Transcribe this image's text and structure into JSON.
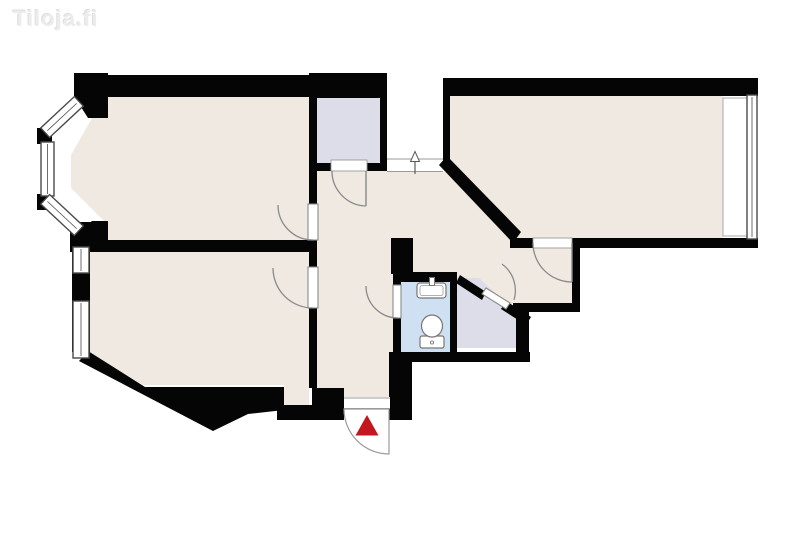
{
  "watermark": {
    "text": "Tiloja.fi"
  },
  "canvas": {
    "width": 800,
    "height": 533
  },
  "colors": {
    "background": "#ffffff",
    "floor_cream": "#f0e9e1",
    "closet_lavender": "#dcdde8",
    "bathroom_blue": "#cfe0f2",
    "wall_black": "#050505",
    "door_gray": "#8a8a8a",
    "thin_line_gray": "#9a9a9a",
    "window_frame": "#4a4a4a",
    "entrance_red": "#c4161f"
  },
  "floorplan": {
    "shapes": [
      {
        "n": "room-topleft-floor",
        "t": "polygon",
        "pts": "104,97 309,97 309,240 104,240 104,221 71,188 71,155",
        "f": "#f0e9e1"
      },
      {
        "n": "room-bottomleft-floor",
        "t": "polygon",
        "pts": "90,252 309,252 309,406 284,406 284,385 143,385 90,354",
        "f": "#f0e9e1"
      },
      {
        "n": "room-topright-floor",
        "t": "rect",
        "x": 450,
        "y": 96,
        "w": 273,
        "h": 142,
        "f": "#f0e9e1"
      },
      {
        "n": "hallway-floor-corridor",
        "t": "rect",
        "x": 317,
        "y": 168,
        "w": 77,
        "h": 241,
        "f": "#f0e9e1"
      },
      {
        "n": "hallway-floor-upper",
        "t": "rect",
        "x": 387,
        "y": 172,
        "w": 56,
        "h": 68,
        "f": "#f0e9e1"
      },
      {
        "n": "hallway-floor-nook",
        "t": "rect",
        "x": 394,
        "y": 172,
        "w": 178,
        "h": 134,
        "f": "#f0e9e1"
      },
      {
        "n": "closet-top-floor",
        "t": "rect",
        "x": 316,
        "y": 98,
        "w": 64,
        "h": 65,
        "f": "#dcdde8"
      },
      {
        "n": "closet-side-floor",
        "t": "polygon",
        "pts": "457,278 479,278 516,313 516,348 457,348",
        "f": "#dcdde8"
      },
      {
        "n": "bathroom-floor",
        "t": "rect",
        "x": 401,
        "y": 282,
        "w": 49,
        "h": 70,
        "f": "#cfe0f2"
      },
      {
        "n": "stair-landing",
        "t": "rect",
        "x": 387,
        "y": 96,
        "w": 56,
        "h": 76,
        "f": "#ffffff"
      },
      {
        "n": "landing-threshold-line-upper",
        "t": "line",
        "x1": 387,
        "y1": 159,
        "x2": 443,
        "y2": 159,
        "s": "#9a9a9a",
        "sw": 1
      },
      {
        "n": "landing-threshold-line-lower",
        "t": "line",
        "x1": 387,
        "y1": 171.5,
        "x2": 443,
        "y2": 171.5,
        "s": "#9a9a9a",
        "sw": 1
      },
      {
        "n": "direction-arrow-icon-stem",
        "t": "line",
        "x1": 415,
        "y1": 174,
        "x2": 415,
        "y2": 161,
        "s": "#5a5a5a",
        "sw": 1.2
      },
      {
        "n": "direction-arrow-icon-head",
        "t": "polygon",
        "pts": "410.5,161.5 419.5,161.5 415,151.5",
        "f": "#ffffff",
        "s": "#5a5a5a",
        "sw": 1
      },
      {
        "n": "wall-room-topleft-top",
        "t": "rect",
        "x": 77,
        "y": 75,
        "w": 241,
        "h": 22,
        "f": "#050505"
      },
      {
        "n": "wall-closet-top-top",
        "t": "rect",
        "x": 309,
        "y": 73,
        "w": 78,
        "h": 25,
        "f": "#050505"
      },
      {
        "n": "wall-closet-top-left",
        "t": "rect",
        "x": 309,
        "y": 97,
        "w": 8,
        "h": 74,
        "f": "#050505"
      },
      {
        "n": "wall-closet-top-right",
        "t": "rect",
        "x": 380,
        "y": 97,
        "w": 7,
        "h": 74,
        "f": "#050505"
      },
      {
        "n": "wall-closet-top-bottom-left",
        "t": "rect",
        "x": 309,
        "y": 163,
        "w": 23,
        "h": 8,
        "f": "#050505"
      },
      {
        "n": "wall-closet-top-bottom-right",
        "t": "rect",
        "x": 366,
        "y": 163,
        "w": 21,
        "h": 8,
        "f": "#050505"
      },
      {
        "n": "wall-hall-left-seg1",
        "t": "rect",
        "x": 309,
        "y": 171,
        "w": 8,
        "h": 34,
        "f": "#050505"
      },
      {
        "n": "wall-hall-left-seg2",
        "t": "rect",
        "x": 309,
        "y": 239,
        "w": 8,
        "h": 29,
        "f": "#050505"
      },
      {
        "n": "wall-hall-left-seg3",
        "t": "rect",
        "x": 309,
        "y": 308,
        "w": 8,
        "h": 80,
        "f": "#050505"
      },
      {
        "n": "wall-between-left-rooms",
        "t": "rect",
        "x": 85,
        "y": 240,
        "w": 232,
        "h": 12,
        "f": "#050505"
      },
      {
        "n": "wall-room-topright-top",
        "t": "rect",
        "x": 443,
        "y": 78,
        "w": 315,
        "h": 18,
        "f": "#050505"
      },
      {
        "n": "wall-room-topright-left",
        "t": "rect",
        "x": 443,
        "y": 96,
        "w": 7,
        "h": 70,
        "f": "#050505"
      },
      {
        "n": "wall-diagonal-hall",
        "t": "polygon",
        "pts": "447,156 521,232 513,243 439,165",
        "f": "#050505"
      },
      {
        "n": "wall-room-topright-bottom-left",
        "t": "rect",
        "x": 510,
        "y": 238,
        "w": 23,
        "h": 10,
        "f": "#050505"
      },
      {
        "n": "wall-room-topright-bottom-right",
        "t": "rect",
        "x": 572,
        "y": 238,
        "w": 186,
        "h": 10,
        "f": "#050505"
      },
      {
        "n": "wall-nook-right",
        "t": "rect",
        "x": 572,
        "y": 238,
        "w": 8,
        "h": 74,
        "f": "#050505"
      },
      {
        "n": "wall-nook-bottom",
        "t": "rect",
        "x": 513,
        "y": 303,
        "w": 67,
        "h": 9,
        "f": "#050505"
      },
      {
        "n": "wall-closet-side-right",
        "t": "rect",
        "x": 516,
        "y": 311,
        "w": 13,
        "h": 41,
        "f": "#050505"
      },
      {
        "n": "wall-bottom-center",
        "t": "rect",
        "x": 393,
        "y": 352,
        "w": 137,
        "h": 10,
        "f": "#050505"
      },
      {
        "n": "wall-bathroom-right",
        "t": "rect",
        "x": 450,
        "y": 272,
        "w": 7,
        "h": 80,
        "f": "#050505"
      },
      {
        "n": "wall-bathroom-top",
        "t": "rect",
        "x": 393,
        "y": 272,
        "w": 64,
        "h": 10,
        "f": "#050505"
      },
      {
        "n": "wall-bathroom-left-upper",
        "t": "rect",
        "x": 393,
        "y": 274,
        "w": 8,
        "h": 11,
        "f": "#050505"
      },
      {
        "n": "wall-bathroom-left-lower",
        "t": "rect",
        "x": 393,
        "y": 318,
        "w": 8,
        "h": 34,
        "f": "#050505"
      },
      {
        "n": "wall-chunk-above-bathroom",
        "t": "rect",
        "x": 391,
        "y": 238,
        "w": 22,
        "h": 36,
        "f": "#050505"
      },
      {
        "n": "wall-closet-side-diag-upper",
        "t": "polygon",
        "pts": "460,275 486,292 482,300 456,283",
        "f": "#050505"
      },
      {
        "n": "wall-closet-side-diag-lower",
        "t": "polygon",
        "pts": "506,301 531,317 526,325 501,309",
        "f": "#050505"
      },
      {
        "n": "wall-entrance-left-jamb",
        "t": "rect",
        "x": 312,
        "y": 388,
        "w": 32,
        "h": 32,
        "f": "#050505"
      },
      {
        "n": "wall-entrance-right-jamb",
        "t": "rect",
        "x": 389,
        "y": 352,
        "w": 23,
        "h": 68,
        "f": "#050505"
      },
      {
        "n": "wall-room-bottomleft-bottom",
        "t": "polygon",
        "pts": "88,351 145,387 284,387 284,410 248,414 213,431 79,361",
        "f": "#050505"
      },
      {
        "n": "wall-notch-bottom",
        "t": "rect",
        "x": 277,
        "y": 405,
        "w": 36,
        "h": 15,
        "f": "#050505"
      },
      {
        "n": "wall-room-bottomleft-left",
        "t": "rect",
        "x": 72,
        "y": 244,
        "w": 18,
        "h": 108,
        "f": "#050505"
      },
      {
        "n": "wall-left-corner-piece",
        "t": "rect",
        "x": 70,
        "y": 222,
        "w": 36,
        "h": 30,
        "f": "#050505"
      },
      {
        "n": "wall-bay-top-corner",
        "t": "polygon",
        "pts": "74,73 108,73 108,118 88,118 74,96",
        "f": "#050505"
      },
      {
        "n": "wall-bay-bottom-corner",
        "t": "polygon",
        "pts": "92,221 108,221 108,252 70,252 70,241",
        "f": "#050505"
      },
      {
        "n": "wall-bay-wedge-upper",
        "t": "rect",
        "x": 37,
        "y": 128,
        "w": 15,
        "h": 16,
        "f": "#050505"
      },
      {
        "n": "wall-bay-wedge-lower",
        "t": "rect",
        "x": 37,
        "y": 194,
        "w": 15,
        "h": 16,
        "f": "#050505"
      },
      {
        "n": "bay-window-top",
        "t": "rect",
        "x": 39,
        "y": 110.5,
        "w": 46,
        "h": 13,
        "f": "#ffffff",
        "s": "#4a4a4a",
        "sw": 1.4,
        "tr": "rotate(-43 62 117)"
      },
      {
        "n": "bay-window-top-glass-line",
        "t": "line",
        "x1": 42,
        "y1": 117,
        "x2": 82,
        "y2": 117,
        "s": "#4a4a4a",
        "sw": 0.8,
        "tr": "rotate(-43 62 117)"
      },
      {
        "n": "bay-window-mid",
        "t": "rect",
        "x": 41,
        "y": 142,
        "w": 13,
        "h": 54,
        "f": "#ffffff",
        "s": "#4a4a4a",
        "sw": 1.4
      },
      {
        "n": "bay-window-mid-glass-line",
        "t": "line",
        "x1": 47.5,
        "y1": 144,
        "x2": 47.5,
        "y2": 194,
        "s": "#4a4a4a",
        "sw": 0.8
      },
      {
        "n": "bay-window-bottom",
        "t": "rect",
        "x": 39,
        "y": 208.5,
        "w": 46,
        "h": 13,
        "f": "#ffffff",
        "s": "#4a4a4a",
        "sw": 1.4,
        "tr": "rotate(43 62 215)"
      },
      {
        "n": "bay-window-bottom-glass-line",
        "t": "line",
        "x1": 42,
        "y1": 215,
        "x2": 82,
        "y2": 215,
        "s": "#4a4a4a",
        "sw": 0.8,
        "tr": "rotate(43 62 215)"
      },
      {
        "n": "window-bottomleft-upper",
        "t": "rect",
        "x": 73,
        "y": 247,
        "w": 16,
        "h": 26,
        "f": "#ffffff",
        "s": "#4a4a4a",
        "sw": 1.4
      },
      {
        "n": "window-bottomleft-upper-glass-line",
        "t": "line",
        "x1": 81,
        "y1": 249,
        "x2": 81,
        "y2": 271,
        "s": "#4a4a4a",
        "sw": 0.8
      },
      {
        "n": "window-bottomleft-lower",
        "t": "rect",
        "x": 73,
        "y": 301,
        "w": 16,
        "h": 57,
        "f": "#ffffff",
        "s": "#4a4a4a",
        "sw": 1.4
      },
      {
        "n": "window-bottomleft-lower-glass-line",
        "t": "line",
        "x1": 81,
        "y1": 303,
        "x2": 81,
        "y2": 356,
        "s": "#4a4a4a",
        "sw": 0.8
      },
      {
        "n": "window-recess-topright",
        "t": "rect",
        "x": 723,
        "y": 98,
        "w": 25,
        "h": 138,
        "f": "#ffffff",
        "s": "#aaaaaa",
        "sw": 1
      },
      {
        "n": "window-topright",
        "t": "rect",
        "x": 747,
        "y": 95,
        "w": 10,
        "h": 144,
        "f": "#ffffff",
        "s": "#4a4a4a",
        "sw": 1.4
      },
      {
        "n": "window-topright-glass-line",
        "t": "line",
        "x1": 752,
        "y1": 97,
        "x2": 752,
        "y2": 237,
        "s": "#4a4a4a",
        "sw": 0.8
      },
      {
        "n": "door-room-topleft-leaf",
        "t": "rect",
        "x": 308,
        "y": 204,
        "w": 10,
        "h": 36,
        "f": "#ffffff",
        "s": "#8a8a8a",
        "sw": 1.1
      },
      {
        "n": "door-room-topleft-arc",
        "t": "path",
        "d": "M 278,205 A 35 35 0 0 0 313,240",
        "s": "#8a8a8a",
        "sw": 1.3
      },
      {
        "n": "door-room-bottomleft-leaf",
        "t": "rect",
        "x": 308,
        "y": 267,
        "w": 10,
        "h": 41,
        "f": "#ffffff",
        "s": "#8a8a8a",
        "sw": 1.1
      },
      {
        "n": "door-room-bottomleft-arc",
        "t": "path",
        "d": "M 273,268 A 40 40 0 0 0 313,308",
        "s": "#8a8a8a",
        "sw": 1.3
      },
      {
        "n": "door-closet-top-threshold",
        "t": "rect",
        "x": 331,
        "y": 160,
        "w": 36,
        "h": 11,
        "f": "#ffffff",
        "s": "#9a9a9a",
        "sw": 0.9
      },
      {
        "n": "door-closet-top-leaf",
        "t": "line",
        "x1": 366,
        "y1": 171,
        "x2": 366,
        "y2": 206,
        "s": "#8a8a8a",
        "sw": 1.4
      },
      {
        "n": "door-closet-top-arc",
        "t": "path",
        "d": "M 332,171 A 35 35 0 0 0 366,206",
        "s": "#8a8a8a",
        "sw": 1.3
      },
      {
        "n": "door-room-topright-threshold",
        "t": "rect",
        "x": 533,
        "y": 238,
        "w": 39,
        "h": 10,
        "f": "#ffffff",
        "s": "#9a9a9a",
        "sw": 0.9
      },
      {
        "n": "door-room-topright-leaf",
        "t": "line",
        "x1": 572,
        "y1": 243,
        "x2": 572,
        "y2": 282,
        "s": "#8a8a8a",
        "sw": 1.4
      },
      {
        "n": "door-room-topright-arc",
        "t": "path",
        "d": "M 533,243 A 39 39 0 0 0 572,282",
        "s": "#8a8a8a",
        "sw": 1.3
      },
      {
        "n": "door-bathroom-leaf",
        "t": "rect",
        "x": 393,
        "y": 285,
        "w": 8,
        "h": 33,
        "f": "#ffffff",
        "s": "#8a8a8a",
        "sw": 1.1
      },
      {
        "n": "door-bathroom-arc",
        "t": "path",
        "d": "M 366,286 A 32 32 0 0 0 398,318",
        "s": "#8a8a8a",
        "sw": 1.3
      },
      {
        "n": "door-closet-side-leaf",
        "t": "polygon",
        "pts": "486,288 510,303 506,309 482,294",
        "f": "#ffffff",
        "s": "#8a8a8a",
        "sw": 1.1
      },
      {
        "n": "door-closet-side-arc",
        "t": "path",
        "d": "M 502,264 A 33 33 0 0 1 514,300",
        "s": "#8a8a8a",
        "sw": 1.3
      },
      {
        "n": "entrance-door-fan",
        "t": "path",
        "d": "M 389,409 L 389,454 A 45 45 0 0 1 344,409 Z",
        "f": "#ffffff",
        "s": "#9a9a9a",
        "sw": 1.2
      },
      {
        "n": "entrance-threshold",
        "t": "rect",
        "x": 344,
        "y": 397,
        "w": 46,
        "h": 12,
        "f": "#ffffff"
      },
      {
        "n": "entrance-threshold-line-upper",
        "t": "line",
        "x1": 344,
        "y1": 398,
        "x2": 390,
        "y2": 398,
        "s": "#9a9a9a",
        "sw": 1
      },
      {
        "n": "entrance-threshold-line-lower",
        "t": "line",
        "x1": 344,
        "y1": 408.5,
        "x2": 390,
        "y2": 408.5,
        "s": "#9a9a9a",
        "sw": 1
      },
      {
        "n": "entrance-triangle-icon",
        "t": "polygon",
        "pts": "367,415 378.5,435.5 355.5,435.5",
        "f": "#c4161f"
      },
      {
        "n": "sink-basin",
        "t": "rect",
        "x": 417,
        "y": 283,
        "w": 29,
        "h": 15,
        "rx": 3,
        "f": "#ffffff",
        "s": "#777777",
        "sw": 1.2
      },
      {
        "n": "sink-basin-inner",
        "t": "rect",
        "x": 420,
        "y": 285.5,
        "w": 23,
        "h": 10,
        "rx": 2,
        "f": "none",
        "s": "#999999",
        "sw": 0.8
      },
      {
        "n": "sink-faucet",
        "t": "rect",
        "x": 429.5,
        "y": 277.5,
        "w": 5,
        "h": 8,
        "f": "#ffffff",
        "s": "#777777",
        "sw": 1
      },
      {
        "n": "toilet-tank",
        "t": "rect",
        "x": 420,
        "y": 336,
        "w": 24,
        "h": 12,
        "rx": 2,
        "f": "#ffffff",
        "s": "#777777",
        "sw": 1.2
      },
      {
        "n": "toilet-bowl",
        "t": "ellipse",
        "cx": 432,
        "cy": 326,
        "rx": 10.5,
        "ry": 11,
        "f": "#ffffff",
        "s": "#777777",
        "sw": 1.2
      },
      {
        "n": "toilet-flush-button",
        "t": "circle",
        "cx": 432,
        "cy": 342.5,
        "r": 1.6,
        "f": "#ffffff",
        "s": "#777777",
        "sw": 0.9
      }
    ]
  }
}
